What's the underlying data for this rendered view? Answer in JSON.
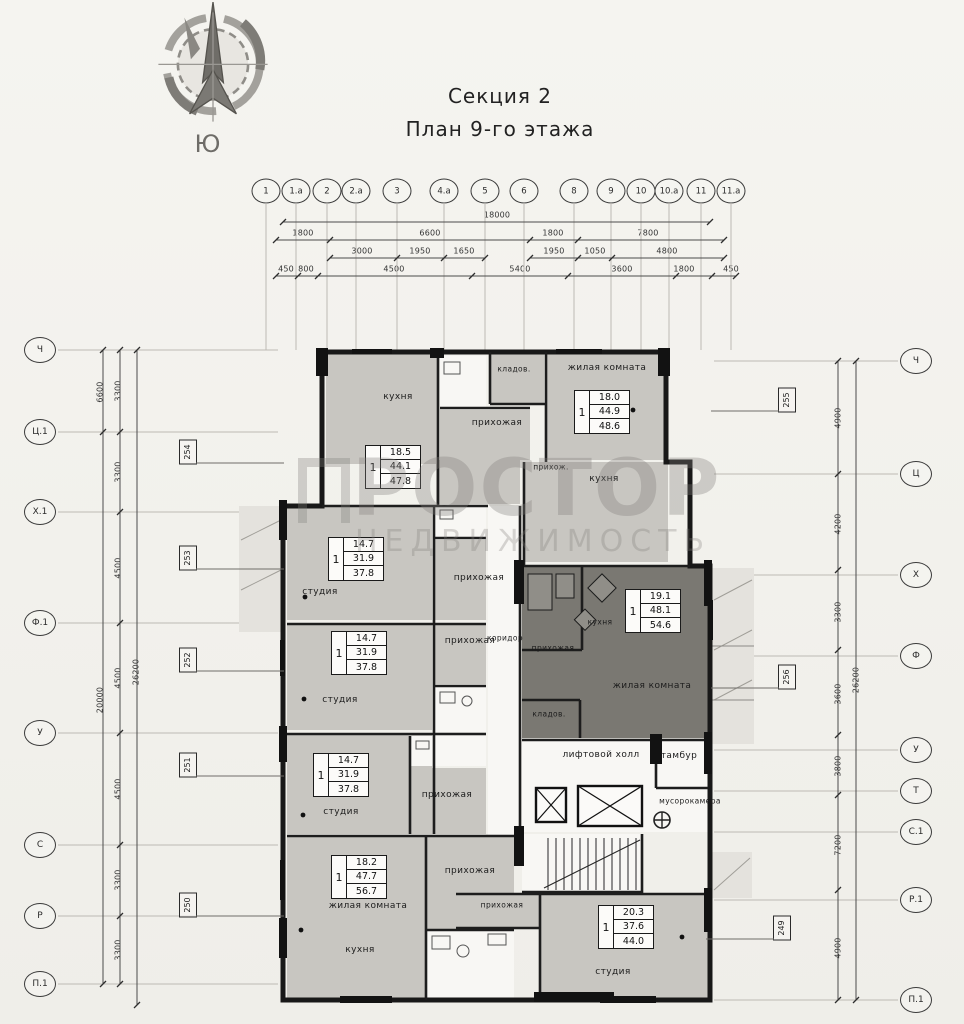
{
  "header": {
    "title": "Секция 2",
    "subtitle": "План 9-го этажа",
    "compass_south": "Ю"
  },
  "watermark": {
    "brand": "РОСТОР",
    "tagline": "НЕДВИЖИМОСТЬ"
  },
  "axes": {
    "top": [
      {
        "label": "1",
        "x": 266
      },
      {
        "label": "1.а",
        "x": 296
      },
      {
        "label": "2",
        "x": 327
      },
      {
        "label": "2.а",
        "x": 356
      },
      {
        "label": "3",
        "x": 397
      },
      {
        "label": "4.а",
        "x": 444
      },
      {
        "label": "5",
        "x": 485
      },
      {
        "label": "6",
        "x": 524
      },
      {
        "label": "8",
        "x": 574
      },
      {
        "label": "9",
        "x": 611
      },
      {
        "label": "10",
        "x": 641
      },
      {
        "label": "10.а",
        "x": 669
      },
      {
        "label": "11",
        "x": 701
      },
      {
        "label": "11.а",
        "x": 731
      }
    ],
    "left": [
      {
        "label": "Ч",
        "y": 350
      },
      {
        "label": "Ц.1",
        "y": 432
      },
      {
        "label": "Х.1",
        "y": 512
      },
      {
        "label": "Ф.1",
        "y": 623
      },
      {
        "label": "У",
        "y": 733
      },
      {
        "label": "С",
        "y": 845
      },
      {
        "label": "Р",
        "y": 916
      },
      {
        "label": "П.1",
        "y": 984
      }
    ],
    "right": [
      {
        "label": "Ч",
        "y": 361
      },
      {
        "label": "Ц",
        "y": 474
      },
      {
        "label": "Х",
        "y": 575
      },
      {
        "label": "Ф",
        "y": 656
      },
      {
        "label": "У",
        "y": 750
      },
      {
        "label": "Т",
        "y": 791
      },
      {
        "label": "С.1",
        "y": 832
      },
      {
        "label": "Р.1",
        "y": 900
      },
      {
        "label": "П.1",
        "y": 1000
      }
    ]
  },
  "dimensions": [
    {
      "text": "18000",
      "x": 497,
      "y": 215
    },
    {
      "text": "1800",
      "x": 303,
      "y": 233
    },
    {
      "text": "6600",
      "x": 430,
      "y": 233
    },
    {
      "text": "1800",
      "x": 553,
      "y": 233
    },
    {
      "text": "7800",
      "x": 648,
      "y": 233
    },
    {
      "text": "3000",
      "x": 362,
      "y": 251
    },
    {
      "text": "1950",
      "x": 420,
      "y": 251
    },
    {
      "text": "1650",
      "x": 464,
      "y": 251
    },
    {
      "text": "1950",
      "x": 554,
      "y": 251
    },
    {
      "text": "1050",
      "x": 595,
      "y": 251
    },
    {
      "text": "4800",
      "x": 667,
      "y": 251
    },
    {
      "text": "450",
      "x": 286,
      "y": 269
    },
    {
      "text": "800",
      "x": 306,
      "y": 269
    },
    {
      "text": "4500",
      "x": 394,
      "y": 269
    },
    {
      "text": "5400",
      "x": 520,
      "y": 269
    },
    {
      "text": "3600",
      "x": 622,
      "y": 269
    },
    {
      "text": "1800",
      "x": 684,
      "y": 269
    },
    {
      "text": "450",
      "x": 731,
      "y": 269
    },
    {
      "text": "6600",
      "x": 100,
      "y": 392,
      "cls": "rot"
    },
    {
      "text": "20000",
      "x": 100,
      "y": 700,
      "cls": "rot"
    },
    {
      "text": "3300",
      "x": 118,
      "y": 391,
      "cls": "rot"
    },
    {
      "text": "3300",
      "x": 118,
      "y": 472,
      "cls": "rot"
    },
    {
      "text": "4500",
      "x": 118,
      "y": 568,
      "cls": "rot"
    },
    {
      "text": "4500",
      "x": 118,
      "y": 678,
      "cls": "rot"
    },
    {
      "text": "4500",
      "x": 118,
      "y": 789,
      "cls": "rot"
    },
    {
      "text": "3300",
      "x": 118,
      "y": 880,
      "cls": "rot"
    },
    {
      "text": "3300",
      "x": 118,
      "y": 950,
      "cls": "rot"
    },
    {
      "text": "26200",
      "x": 136,
      "y": 672,
      "cls": "rot"
    },
    {
      "text": "4900",
      "x": 838,
      "y": 418,
      "cls": "rot"
    },
    {
      "text": "4200",
      "x": 838,
      "y": 524,
      "cls": "rot"
    },
    {
      "text": "3300",
      "x": 838,
      "y": 612,
      "cls": "rot"
    },
    {
      "text": "3600",
      "x": 838,
      "y": 694,
      "cls": "rot"
    },
    {
      "text": "3800",
      "x": 838,
      "y": 766,
      "cls": "rot"
    },
    {
      "text": "7200",
      "x": 838,
      "y": 845,
      "cls": "rot"
    },
    {
      "text": "4900",
      "x": 838,
      "y": 948,
      "cls": "rot"
    },
    {
      "text": "26200",
      "x": 856,
      "y": 680,
      "cls": "rot"
    }
  ],
  "room_labels": [
    {
      "text": "кухня",
      "x": 398,
      "y": 397
    },
    {
      "text": "прихожая",
      "x": 497,
      "y": 423
    },
    {
      "text": "кладов.",
      "x": 514,
      "y": 369,
      "cls": "sm"
    },
    {
      "text": "жилая комната",
      "x": 607,
      "y": 368
    },
    {
      "text": "прихож.",
      "x": 551,
      "y": 467,
      "cls": "sm"
    },
    {
      "text": "кухня",
      "x": 604,
      "y": 479
    },
    {
      "text": "студия",
      "x": 320,
      "y": 592
    },
    {
      "text": "прихожая",
      "x": 479,
      "y": 578
    },
    {
      "text": "студия",
      "x": 340,
      "y": 700
    },
    {
      "text": "прихожая",
      "x": 470,
      "y": 641
    },
    {
      "text": "коридор",
      "x": 505,
      "y": 638,
      "cls": "sm"
    },
    {
      "text": "кухня",
      "x": 600,
      "y": 622,
      "cls": "sm"
    },
    {
      "text": "прихожая",
      "x": 553,
      "y": 648,
      "cls": "sm"
    },
    {
      "text": "жилая комната",
      "x": 652,
      "y": 686
    },
    {
      "text": "кладов.",
      "x": 549,
      "y": 714,
      "cls": "sm"
    },
    {
      "text": "студия",
      "x": 341,
      "y": 812
    },
    {
      "text": "прихожая",
      "x": 447,
      "y": 795
    },
    {
      "text": "лифтовой холл",
      "x": 601,
      "y": 755
    },
    {
      "text": "тамбур",
      "x": 679,
      "y": 756
    },
    {
      "text": "мусорокамера",
      "x": 690,
      "y": 801,
      "cls": "sm"
    },
    {
      "text": "жилая комната",
      "x": 368,
      "y": 906
    },
    {
      "text": "прихожая",
      "x": 470,
      "y": 871
    },
    {
      "text": "кухня",
      "x": 360,
      "y": 950
    },
    {
      "text": "прихожая",
      "x": 502,
      "y": 905,
      "cls": "sm"
    },
    {
      "text": "студия",
      "x": 613,
      "y": 972
    }
  ],
  "apartment_stats": [
    {
      "rooms": "1",
      "area_room": "18.5",
      "area_apartment": "44.1",
      "area_total": "47.8",
      "x": 393,
      "y": 467
    },
    {
      "rooms": "1",
      "area_room": "18.0",
      "area_apartment": "44.9",
      "area_total": "48.6",
      "x": 602,
      "y": 412
    },
    {
      "rooms": "1",
      "area_room": "14.7",
      "area_apartment": "31.9",
      "area_total": "37.8",
      "x": 356,
      "y": 559
    },
    {
      "rooms": "1",
      "area_room": "14.7",
      "area_apartment": "31.9",
      "area_total": "37.8",
      "x": 359,
      "y": 653
    },
    {
      "rooms": "1",
      "area_room": "19.1",
      "area_apartment": "48.1",
      "area_total": "54.6",
      "x": 653,
      "y": 611
    },
    {
      "rooms": "1",
      "area_room": "14.7",
      "area_apartment": "31.9",
      "area_total": "37.8",
      "x": 341,
      "y": 775
    },
    {
      "rooms": "1",
      "area_room": "18.2",
      "area_apartment": "47.7",
      "area_total": "56.7",
      "x": 359,
      "y": 877
    },
    {
      "rooms": "1",
      "area_room": "20.3",
      "area_apartment": "37.6",
      "area_total": "44.0",
      "x": 626,
      "y": 927
    }
  ],
  "apartment_tags": [
    {
      "number": "254",
      "x": 188,
      "y": 452,
      "cls": "side-left"
    },
    {
      "number": "253",
      "x": 188,
      "y": 558,
      "cls": "side-left"
    },
    {
      "number": "252",
      "x": 188,
      "y": 660,
      "cls": "side-left"
    },
    {
      "number": "251",
      "x": 188,
      "y": 765,
      "cls": "side-left"
    },
    {
      "number": "250",
      "x": 188,
      "y": 905,
      "cls": "side-left"
    },
    {
      "number": "255",
      "x": 787,
      "y": 400,
      "cls": "side-right"
    },
    {
      "number": "256",
      "x": 787,
      "y": 677,
      "cls": "side-right"
    },
    {
      "number": "249",
      "x": 782,
      "y": 928,
      "cls": "side-right"
    }
  ]
}
